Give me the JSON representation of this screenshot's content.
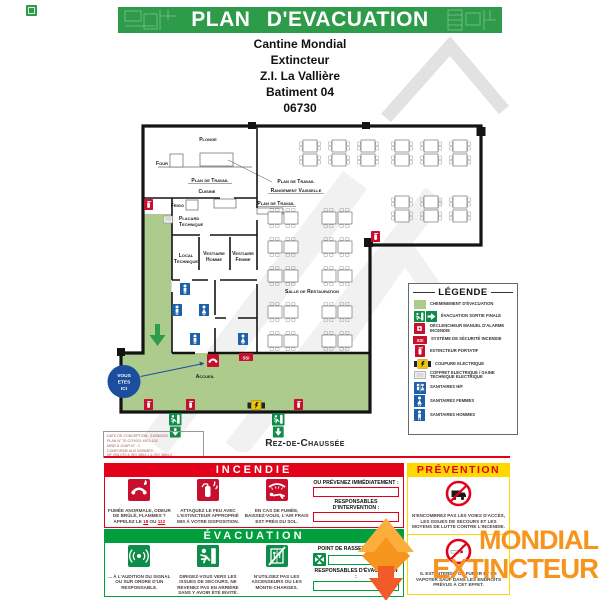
{
  "header": {
    "title": "PLAN D'EVACUATION"
  },
  "site": {
    "l1": "Cantine Mondial",
    "l2": "Extincteur",
    "l3": "Z.I. La Vallière",
    "l4": "Batiment 04",
    "l5": "06730"
  },
  "plan": {
    "floor_label": "Rez-de-Chaussée",
    "ssi": "SSI",
    "you_are_here": {
      "l1": "VOUS",
      "l2": "ETES",
      "l3": "ICI"
    },
    "rooms": {
      "plonge": "Plonge",
      "four": "Four",
      "plan_travail_1": "Plan de Travail",
      "cuisine": "Cuisine",
      "plan_travail_2": "Plan de Travail",
      "rangement": "Rangement Vaisselle",
      "plan_travail_3": "Plan de Travail",
      "frigo": "Frigo",
      "placard_1": "Placard",
      "placard_2": "Technique",
      "local_1": "Local",
      "local_2": "Technique",
      "vestiaire_h_1": "Vestiaire",
      "vestiaire_h_2": "Homme",
      "vestiaire_f_1": "Vestiaire",
      "vestiaire_f_2": "Femme",
      "salle": "Salle de Restauration",
      "accueil": "Accueil"
    },
    "info": {
      "l1": "DATE DE CONCEPTION : 21/08/2020",
      "l2": "PLAN N° 70-COY001-4974-102",
      "l3": "MISE À JOUR N° : 1",
      "l4": "CONFORME AUX NORMES :",
      "l5": "NF X08-070 & ISO 3864-1 & ISO 3864-3"
    }
  },
  "legend": {
    "title": "LÉGENDE",
    "items": [
      {
        "label": "CHEMINEMENT D'ÉVACUATION"
      },
      {
        "label": "ÉVACUATION SORTIE FINALE"
      },
      {
        "label": "DÉCLENCHEUR MANUEL D'ALARME INCENDIE"
      },
      {
        "label": "SYSTÈME DE SÉCURITÉ INCENDIE"
      },
      {
        "label": "EXTINCTEUR PORTATIF"
      },
      {
        "label": "COUPURE ELECTRIQUE"
      },
      {
        "label": "COFFRET ELECTRIQUE / GAINE TECHNIQUE ELECTRIQUE"
      },
      {
        "label": "SANITAIRES H/F"
      },
      {
        "label": "SANITAIRES FEMMES"
      },
      {
        "label": "SANITAIRES HOMMES"
      }
    ]
  },
  "incendie": {
    "title": "INCENDIE",
    "step1": {
      "l1": "FUMÉE ANORMALE, ODEUR",
      "l2": "DE BRÛLÉ, FLAMMES ?",
      "l3a": "APPELEZ LE",
      "n1": "18",
      "ou": "OU",
      "n2": "112"
    },
    "step2": "ATTAQUEZ LE FEU AVEC L'EXTINCTEUR APPROPRIÉ MIS À VOTRE DISPOSITION.",
    "step3": "EN CAS DE FUMÉE, BAISSEZ-VOUS, L'AIR FRAIS EST PRÈS DU SOL.",
    "right": {
      "prevenez": "OU PRÉVENEZ IMMÉDIATEMENT :",
      "responsables": "RESPONSABLES D'INTERVENTION :"
    }
  },
  "evacuation": {
    "title": "ÉVACUATION",
    "step1": "... À L'AUDITION DU SIGNAL OU SUR ORDRE D'UN RESPONSABLE.",
    "step2": "DIRIGEZ-VOUS VERS LES ISSUES DE SECOURS. NE REVENEZ PAS EN ARRIÈRE SANS Y AVOIR ÉTÉ INVITÉ.",
    "step3": "N'UTILISEZ PAS LES ASCENSEURS OU LES MONTE-CHARGES.",
    "right": {
      "point": "POINT DE RASSEMBLEMENT :",
      "responsables": "RESPONSABLES D'ÉVACUATION :"
    }
  },
  "prevention": {
    "title": "PRÉVENTION",
    "step1": "N'ENCOMBREZ PAS LES VOIES D'ACCÈS, LES ISSUES DE SECOURS ET LES MOYENS DE LUTTE CONTRE L'INCENDIE.",
    "step2": "IL EST INTERDIT DE FUMER ET DE VAPOTER SAUF DANS LES ENDROITS PRÉVUS À CET EFFET."
  },
  "brand": {
    "line1": "MONDIAL",
    "line2": "EXTINCTEUR"
  },
  "colors": {
    "banner_green": "#2E9B4B",
    "signal_green": "#009E3D",
    "sign_green": "#0E8C4A",
    "path_green": "#AECB8E",
    "alert_red": "#E2001A",
    "icon_red": "#C8102E",
    "prevention_yellow": "#FFD800",
    "sanitary_blue": "#1D60A8",
    "badge_blue": "#1B4F9E",
    "brand_orange": "#F7941D"
  }
}
